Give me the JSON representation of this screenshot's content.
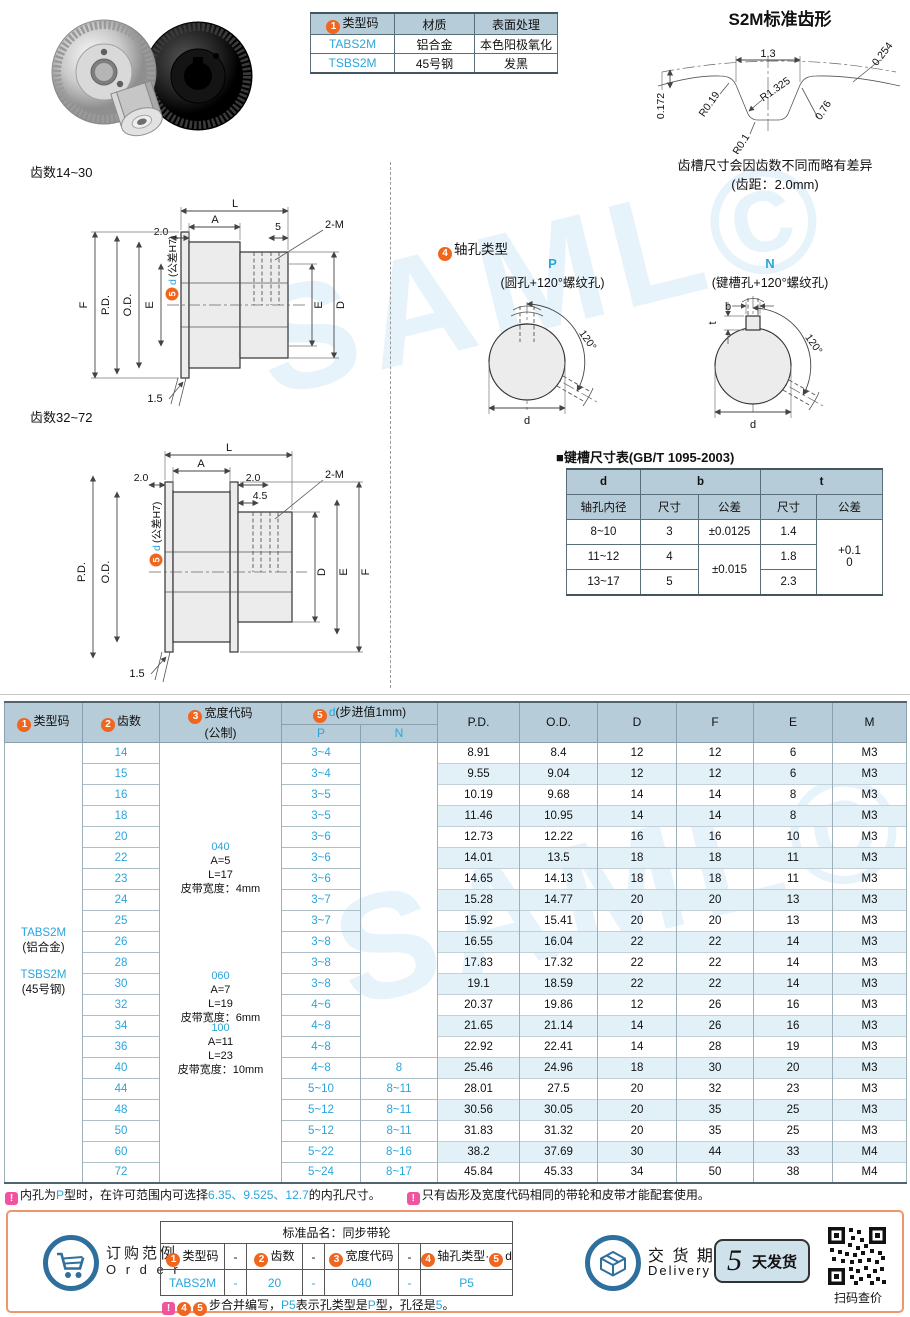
{
  "watermark": "SAML©",
  "badges": {
    "n1": "1",
    "n2": "2",
    "n3": "3",
    "n4": "4",
    "n5": "5",
    "excl": "!"
  },
  "top_table": {
    "headers": [
      "类型码",
      "材质",
      "表面处理"
    ],
    "rows": [
      [
        "TABS2M",
        "铝合金",
        "本色阳极氧化"
      ],
      [
        "TSBS2M",
        "45号钢",
        "发黑"
      ]
    ]
  },
  "tooth_profile": {
    "title": "S2M标准齿形",
    "w": "1.3",
    "c1": "0.254",
    "r1": "R1.325",
    "r2": "R0.19",
    "h": "0.172",
    "f": "0.76",
    "r3": "R0.1",
    "note1": "齿槽尺寸会因齿数不同而略有差异",
    "note2": "(齿距：2.0mm)"
  },
  "drawing1": {
    "title": "齿数14~30",
    "L": "L",
    "A": "A",
    "left": "2.0",
    "right": "5",
    "screws": "2-M",
    "d": "d",
    "dtol": "(公差H7)",
    "F": "F",
    "PD": "P.D.",
    "OD": "O.D.",
    "E": "E",
    "E2": "E",
    "D": "D",
    "chamfer": "1.5"
  },
  "drawing2": {
    "title": "齿数32~72",
    "L": "L",
    "A": "A",
    "left": "2.0",
    "right": "2.0",
    "step": "4.5",
    "screws": "2-M",
    "d": "d",
    "dtol": "(公差H7)",
    "PD": "P.D.",
    "OD": "O.D.",
    "D": "D",
    "E": "E",
    "F": "F",
    "chamfer": "1.5"
  },
  "shaft": {
    "title": "轴孔类型",
    "p": "P",
    "p_desc": "(圆孔+120°螺纹孔)",
    "n": "N",
    "n_desc": "(键槽孔+120°螺纹孔)",
    "angle": "120°",
    "d": "d",
    "b": "b",
    "t": "t"
  },
  "keyway": {
    "title": "■键槽尺寸表(GB/T 1095-2003)",
    "d": "d",
    "d_sub": "轴孔内径",
    "b": "b",
    "t": "t",
    "size": "尺寸",
    "tol": "公差",
    "r1": [
      "8~10",
      "3",
      "±0.0125",
      "1.4"
    ],
    "r2": [
      "11~12",
      "4",
      "±0.015",
      "1.8"
    ],
    "r3": [
      "13~17",
      "5",
      "2.3"
    ],
    "t_tol1": "+0.1",
    "t_tol2": "0"
  },
  "main_table": {
    "h_type": "类型码",
    "h_teeth": "齿数",
    "h_width1": "宽度代码",
    "h_width2": "(公制)",
    "h_d_blue": "d",
    "h_d_rest": "(步进值1mm)",
    "h_p": "P",
    "h_n": "N",
    "h_cols": [
      "P.D.",
      "O.D.",
      "D",
      "F",
      "E",
      "M"
    ],
    "h_keys": [
      "pd",
      "od",
      "d",
      "f",
      "e",
      "m"
    ],
    "type_cell": [
      "TABS2M",
      "(铝合金)",
      "TSBS2M",
      "(45号钢)"
    ],
    "width_groups": [
      {
        "code": "040",
        "a": "A=5",
        "l": "L=17",
        "belt": "皮带宽度：4mm"
      },
      {
        "code": "060",
        "a": "A=7",
        "l": "L=19",
        "belt": "皮带宽度：6mm"
      },
      {
        "code": "100",
        "a": "A=11",
        "l": "L=23",
        "belt": "皮带宽度：10mm"
      }
    ],
    "rows": [
      {
        "t": "14",
        "p": "3~4",
        "n": "",
        "v": [
          "8.91",
          "8.4",
          "12",
          "12",
          "6",
          "M3"
        ]
      },
      {
        "t": "15",
        "p": "3~4",
        "n": "",
        "v": [
          "9.55",
          "9.04",
          "12",
          "12",
          "6",
          "M3"
        ]
      },
      {
        "t": "16",
        "p": "3~5",
        "n": "",
        "v": [
          "10.19",
          "9.68",
          "14",
          "14",
          "8",
          "M3"
        ]
      },
      {
        "t": "18",
        "p": "3~5",
        "n": "",
        "v": [
          "11.46",
          "10.95",
          "14",
          "14",
          "8",
          "M3"
        ]
      },
      {
        "t": "20",
        "p": "3~6",
        "n": "",
        "v": [
          "12.73",
          "12.22",
          "16",
          "16",
          "10",
          "M3"
        ]
      },
      {
        "t": "22",
        "p": "3~6",
        "n": "",
        "v": [
          "14.01",
          "13.5",
          "18",
          "18",
          "11",
          "M3"
        ]
      },
      {
        "t": "23",
        "p": "3~6",
        "n": "",
        "v": [
          "14.65",
          "14.13",
          "18",
          "18",
          "11",
          "M3"
        ]
      },
      {
        "t": "24",
        "p": "3~7",
        "n": "",
        "v": [
          "15.28",
          "14.77",
          "20",
          "20",
          "13",
          "M3"
        ]
      },
      {
        "t": "25",
        "p": "3~7",
        "n": "",
        "v": [
          "15.92",
          "15.41",
          "20",
          "20",
          "13",
          "M3"
        ]
      },
      {
        "t": "26",
        "p": "3~8",
        "n": "",
        "v": [
          "16.55",
          "16.04",
          "22",
          "22",
          "14",
          "M3"
        ]
      },
      {
        "t": "28",
        "p": "3~8",
        "n": "",
        "v": [
          "17.83",
          "17.32",
          "22",
          "22",
          "14",
          "M3"
        ]
      },
      {
        "t": "30",
        "p": "3~8",
        "n": "",
        "v": [
          "19.1",
          "18.59",
          "22",
          "22",
          "14",
          "M3"
        ]
      },
      {
        "t": "32",
        "p": "4~6",
        "n": "",
        "v": [
          "20.37",
          "19.86",
          "12",
          "26",
          "16",
          "M3"
        ]
      },
      {
        "t": "34",
        "p": "4~8",
        "n": "",
        "v": [
          "21.65",
          "21.14",
          "14",
          "26",
          "16",
          "M3"
        ]
      },
      {
        "t": "36",
        "p": "4~8",
        "n": "",
        "v": [
          "22.92",
          "22.41",
          "14",
          "28",
          "19",
          "M3"
        ]
      },
      {
        "t": "40",
        "p": "4~8",
        "n": "8",
        "v": [
          "25.46",
          "24.96",
          "18",
          "30",
          "20",
          "M3"
        ]
      },
      {
        "t": "44",
        "p": "5~10",
        "n": "8~11",
        "v": [
          "28.01",
          "27.5",
          "20",
          "32",
          "23",
          "M3"
        ]
      },
      {
        "t": "48",
        "p": "5~12",
        "n": "8~11",
        "v": [
          "30.56",
          "30.05",
          "20",
          "35",
          "25",
          "M3"
        ]
      },
      {
        "t": "50",
        "p": "5~12",
        "n": "8~11",
        "v": [
          "31.83",
          "31.32",
          "20",
          "35",
          "25",
          "M3"
        ]
      },
      {
        "t": "60",
        "p": "5~22",
        "n": "8~16",
        "v": [
          "38.2",
          "37.69",
          "30",
          "44",
          "33",
          "M4"
        ]
      },
      {
        "t": "72",
        "p": "5~24",
        "n": "8~17",
        "v": [
          "45.84",
          "45.33",
          "34",
          "50",
          "38",
          "M4"
        ]
      }
    ]
  },
  "notes": {
    "n1a": "内孔为",
    "n1b": "P",
    "n1c": "型时，在许可范围内可选择",
    "n1d": "6.35、9.525、12.7",
    "n1e": "的内孔尺寸。",
    "n2": "只有齿形及宽度代码相同的带轮和皮带才能配套使用。"
  },
  "order": {
    "cn": "订购范例",
    "en": "O r d e r",
    "product": "标准品名：同步带轮",
    "h1": "类型码",
    "h2": "齿数",
    "h3": "宽度代码",
    "h4a": "轴孔类型·",
    "h4b": "d",
    "dash": "-",
    "v": [
      "TABS2M",
      "20",
      "040",
      "P5"
    ],
    "note_pre": "步合并编写，",
    "note_b1": "P5",
    "note_m1": "表示孔类型是",
    "note_b2": "P",
    "note_m2": "型，孔径是",
    "note_b3": "5",
    "note_end": "。"
  },
  "delivery": {
    "cn": "交 货 期",
    "en": "Delivery",
    "days": "5",
    "ship": "天发货",
    "qr": "扫码查价"
  }
}
